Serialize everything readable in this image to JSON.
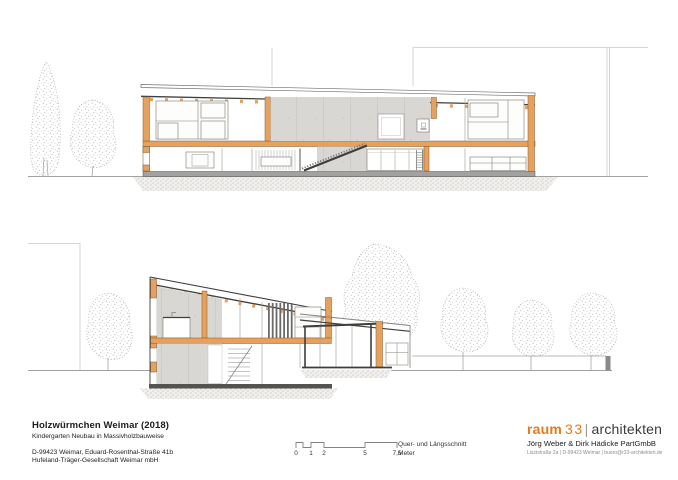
{
  "title_block": {
    "project_title": "Holzwürmchen Weimar (2018)",
    "project_subtitle": "Kindergarten Neubau in Massivholzbauweise",
    "address_line1": "D-99423 Weimar, Eduard-Rosenthal-Straße 41b",
    "address_line2": "Hufeland-Träger-Gesellschaft Weimar mbH"
  },
  "scale_bar": {
    "tick_labels": [
      "0",
      "1",
      "2",
      "5",
      "7,5"
    ],
    "caption_line1": "Quer- und Längsschnitt",
    "caption_line2": "Meter"
  },
  "logo": {
    "word1": "raum",
    "word2": "33",
    "separator": "|",
    "word3": "architekten",
    "partners_line": "Jörg Weber & Dirk Hädicke PartGmbB",
    "contact_line": "Lisztstraße 2a | D-99423 Weimar | buero@r33-architekten.de"
  },
  "colors": {
    "wood_accent": "#e8a15c",
    "logo_orange": "#e87a1e",
    "concrete_gray": "#d8d7d4",
    "slab_gray": "#a3a2a0",
    "line_dark": "#3e3e3c",
    "line_faint": "#cbcac7"
  }
}
